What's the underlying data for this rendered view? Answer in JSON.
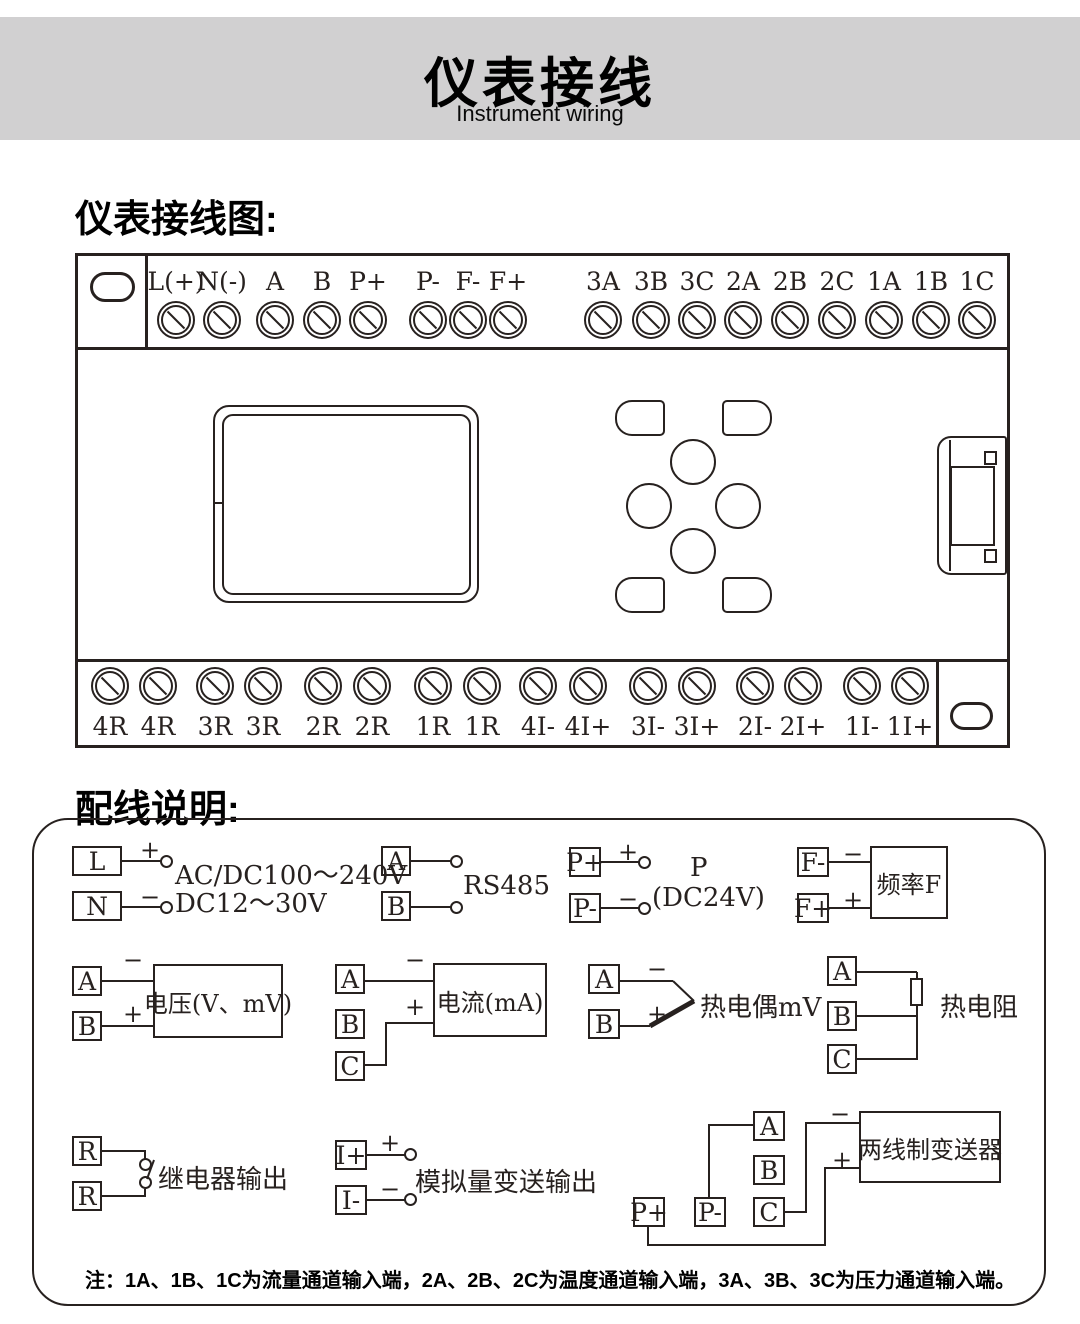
{
  "banner": {
    "title": "仪表接线",
    "subtitle": "Instrument wiring"
  },
  "sections": {
    "diagram_heading": "仪表接线图:",
    "wiring_heading": "配线说明:"
  },
  "device": {
    "top_terminals": [
      "L(+)",
      "N(-)",
      "A",
      "B",
      "P+",
      "P-",
      "F-",
      "F+",
      "3A",
      "3B",
      "3C",
      "2A",
      "2B",
      "2C",
      "1A",
      "1B",
      "1C"
    ],
    "bottom_terminals": [
      "4R",
      "4R",
      "3R",
      "3R",
      "2R",
      "2R",
      "1R",
      "1R",
      "4I-",
      "4I+",
      "3I-",
      "3I+",
      "2I-",
      "2I+",
      "1I-",
      "1I+"
    ]
  },
  "wiring": {
    "power": {
      "t": [
        "L",
        "N"
      ],
      "plus": "+",
      "minus": "−",
      "line1": "AC/DC100～240V",
      "line2": "DC12～30V"
    },
    "rs485": {
      "t": [
        "A",
        "B"
      ],
      "label": "RS485"
    },
    "power_out": {
      "t": [
        "P+",
        "P-"
      ],
      "plus": "+",
      "minus": "−",
      "line1": "P",
      "line2": "(DC24V)"
    },
    "frequency": {
      "t": [
        "F-",
        "F+"
      ],
      "plus": "+",
      "minus": "−",
      "box": "频率F"
    },
    "voltage": {
      "t": [
        "A",
        "B"
      ],
      "plus": "+",
      "minus": "−",
      "box": "电压(V、mV)"
    },
    "current": {
      "t": [
        "A",
        "B",
        "C"
      ],
      "plus": "+",
      "minus": "−",
      "box": "电流(mA)"
    },
    "thermocouple": {
      "t": [
        "A",
        "B"
      ],
      "plus": "+",
      "minus": "−",
      "label": "热电偶mV"
    },
    "rtd": {
      "t": [
        "A",
        "B",
        "C"
      ],
      "label": "热电阻"
    },
    "relay": {
      "t": [
        "R",
        "R"
      ],
      "label": "继电器输出"
    },
    "analog_out": {
      "t": [
        "I+",
        "I-"
      ],
      "plus": "+",
      "minus": "−",
      "label": "模拟量变送输出"
    },
    "transmitter": {
      "t": [
        "P+",
        "P-",
        "A",
        "B",
        "C"
      ],
      "plus": "+",
      "minus": "−",
      "box": "两线制变送器"
    }
  },
  "note": "注：1A、1B、1C为流量通道输入端，2A、2B、2C为温度通道输入端，3A、3B、3C为压力通道输入端。"
}
